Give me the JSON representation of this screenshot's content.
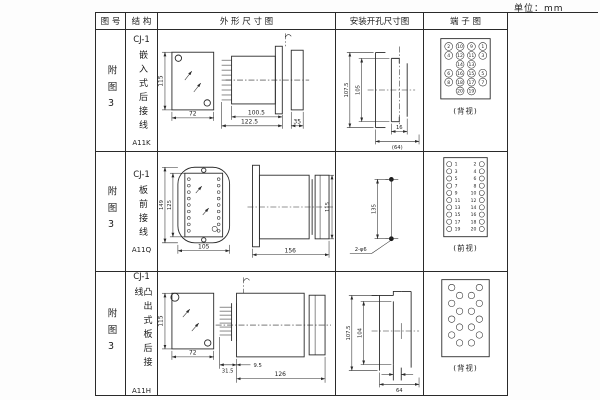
{
  "unit_label": "单位：mm",
  "headers": {
    "figure": "图 号",
    "structure": "结 构",
    "outline": "外 形 尺 寸 图",
    "mounting": "安装开孔尺寸图",
    "terminal": "端 子 图"
  },
  "rows": [
    {
      "figure_no": "附图3",
      "model": "CJ-1",
      "structure": "嵌入式后接线",
      "code": "A11K",
      "outline": {
        "h": "115",
        "w": "72",
        "d1": "100.5",
        "d2": "122.5",
        "d3": "35"
      },
      "mounting": {
        "outer": "107.5",
        "inner": "105",
        "slot": "16",
        "width": "(64)"
      },
      "terminal": {
        "view": "(背视)",
        "numbers": [
          [
            "2",
            "10",
            "9",
            "1"
          ],
          [
            "4",
            "12",
            "11",
            "3"
          ],
          [
            "14",
            "13"
          ],
          [
            "6",
            "16",
            "15",
            "5"
          ],
          [
            "8",
            "18",
            "17",
            "7"
          ],
          [
            "20",
            "19"
          ]
        ]
      }
    },
    {
      "figure_no": "附图3",
      "model": "CJ-1",
      "structure": "板前接线",
      "code": "A11Q",
      "outline": {
        "outer_h": "149",
        "inner_h": "125",
        "w": "105",
        "len": "156",
        "side_h": "115"
      },
      "mounting": {
        "spacing": "135",
        "holes": "2-φ6"
      },
      "terminal": {
        "view": "(前视)",
        "left": [
          "1",
          "3",
          "5",
          "7",
          "9",
          "11",
          "13",
          "15",
          "17",
          "19"
        ],
        "right": [
          "2",
          "4",
          "6",
          "8",
          "10",
          "12",
          "14",
          "16",
          "18",
          "20"
        ]
      }
    },
    {
      "figure_no": "附图3",
      "model": "CJ-1",
      "structure": "凸出式板后接线",
      "code": "A11H",
      "outline": {
        "h": "115",
        "w": "72",
        "d1": "31.5",
        "d2": "9.5",
        "d3": "126"
      },
      "mounting": {
        "outer": "107.5",
        "inner": "104",
        "width": "64"
      },
      "terminal": {
        "view": "(背视)"
      }
    }
  ]
}
